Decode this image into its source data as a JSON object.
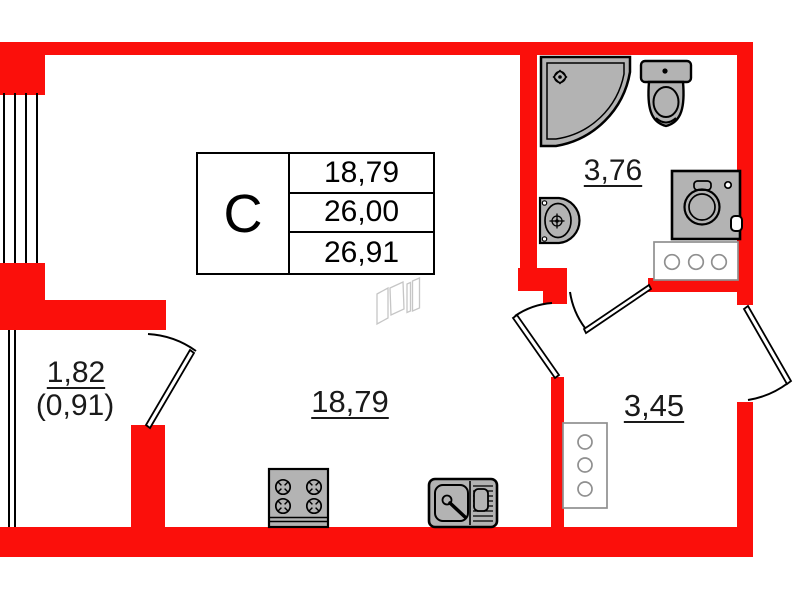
{
  "unit_table": {
    "type_label": "С",
    "rows": [
      "18,79",
      "26,00",
      "26,91"
    ]
  },
  "room_labels": {
    "bathroom": "3,76",
    "living_kitchen": "18,79",
    "hallway": "3,45",
    "balcony": "1,82",
    "balcony_reduced": "(0,91)"
  },
  "colors": {
    "wall": "#fb0f0b",
    "fixture_fill": "#b3b3b3",
    "outline": "#000000",
    "furniture_stroke": "#8f8f8f",
    "watermark": "#c6c6c6"
  },
  "fixtures": [
    "shower",
    "toilet",
    "wash-basin",
    "washing-machine",
    "washer-counter",
    "hall-cabinet",
    "stove",
    "kitchen-sink"
  ]
}
